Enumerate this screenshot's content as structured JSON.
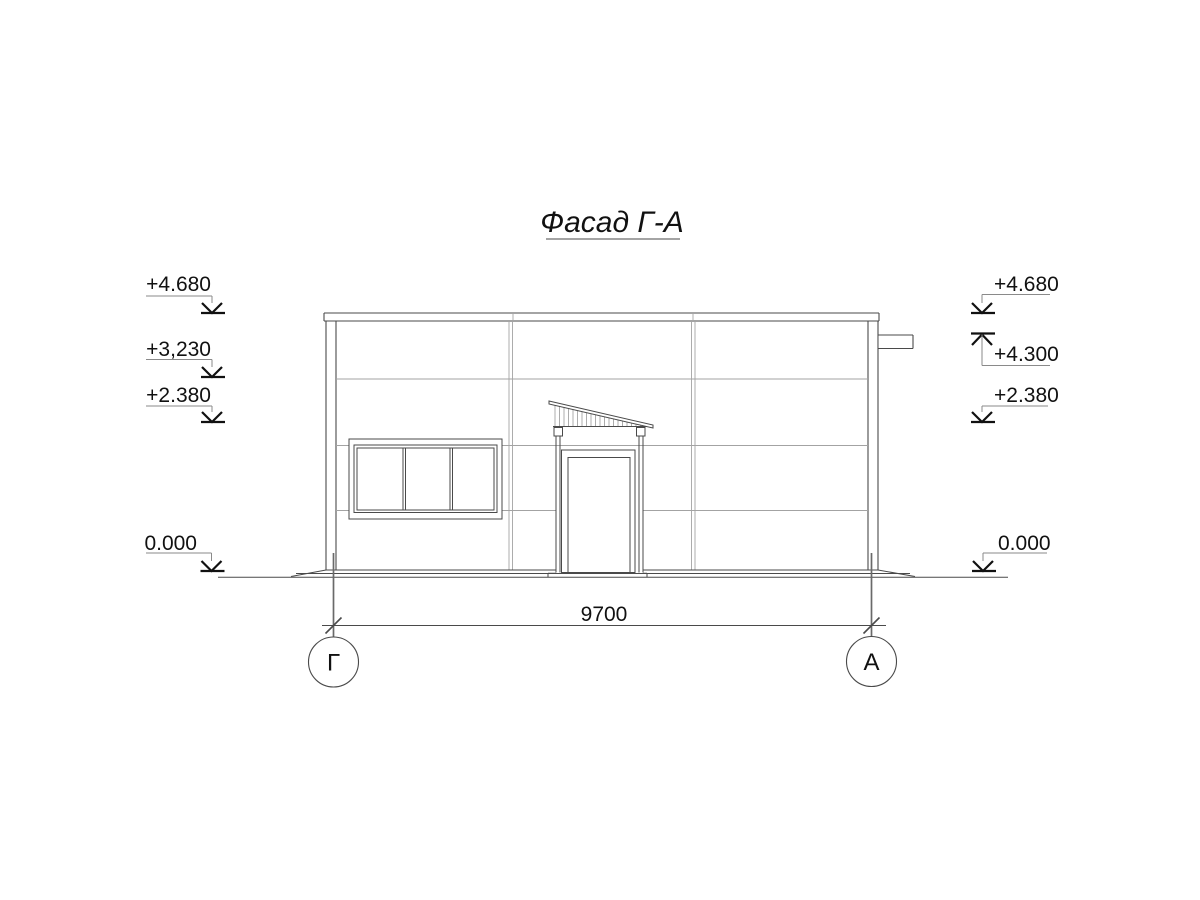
{
  "drawing": {
    "title": "Фасад Г-А"
  },
  "elevation_marks": {
    "left": [
      {
        "id": "left-plus-4680",
        "label": "+4.680"
      },
      {
        "id": "left-plus-3230",
        "label": "+3,230"
      },
      {
        "id": "left-plus-2380",
        "label": "+2.380"
      },
      {
        "id": "left-zero",
        "label": "0.000"
      }
    ],
    "right": [
      {
        "id": "right-plus-4680",
        "label": "+4.680"
      },
      {
        "id": "right-plus-4300",
        "label": "+4.300"
      },
      {
        "id": "right-plus-2380",
        "label": "+2.380"
      },
      {
        "id": "right-zero",
        "label": "0.000"
      }
    ]
  },
  "dimension": {
    "label": "9700"
  },
  "axis_bubbles": [
    {
      "label": "Г"
    },
    {
      "label": "А"
    }
  ],
  "colors": {
    "bg": "#ffffff",
    "line": "#4a4a4a",
    "joint": "#a3a3a3",
    "axis": "#6a6a6a",
    "text": "#111111"
  }
}
